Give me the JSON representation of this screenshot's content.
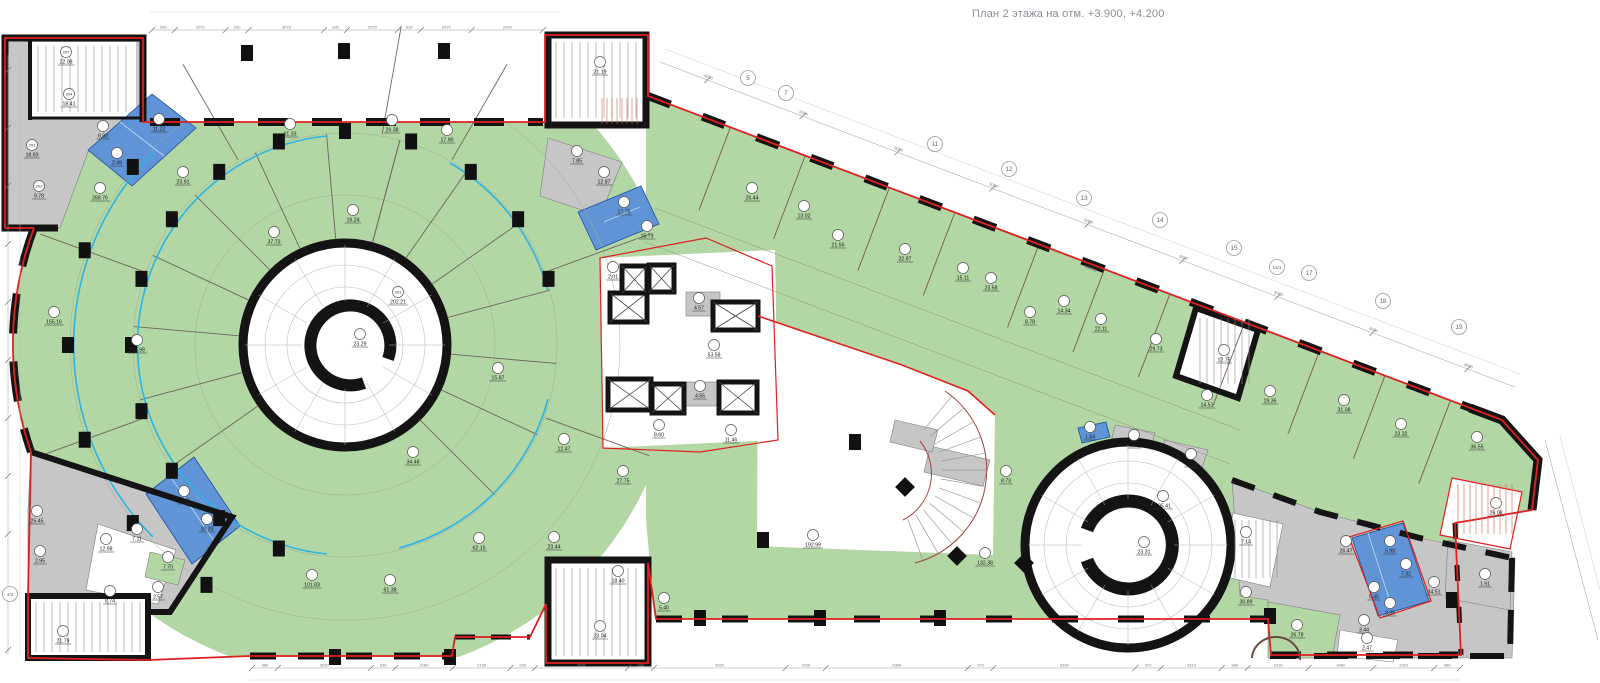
{
  "title": "План 2 этажа на отм. +3.900, +4.200",
  "colors": {
    "floor_green": "#b2d6a4",
    "wet_room_blue": "#6194d6",
    "service_gray": "#c6c6c6",
    "boundary_red": "#e02020",
    "partition_cyan": "#2ab5e8",
    "wall_black": "#141414"
  },
  "plan": {
    "rooms": [
      {
        "no": "207",
        "area": "22.08",
        "x": 66,
        "y": 62
      },
      {
        "no": "204",
        "area": "18.41",
        "x": 69,
        "y": 104
      },
      {
        "no": "203",
        "area": "18.83",
        "x": 32,
        "y": 155
      },
      {
        "no": "202",
        "area": "9.78",
        "x": 39,
        "y": 196
      },
      {
        "no": "",
        "area": "8.93",
        "x": 103,
        "y": 136
      },
      {
        "no": "",
        "area": "11.22",
        "x": 159,
        "y": 129
      },
      {
        "no": "",
        "area": "2.49",
        "x": 117,
        "y": 163
      },
      {
        "no": "",
        "area": "23.91",
        "x": 183,
        "y": 182
      },
      {
        "no": "",
        "area": "268.76",
        "x": 100,
        "y": 198
      },
      {
        "no": "",
        "area": "61.33",
        "x": 290,
        "y": 134
      },
      {
        "no": "",
        "area": "29.38",
        "x": 392,
        "y": 130
      },
      {
        "no": "",
        "area": "17.90",
        "x": 447,
        "y": 140
      },
      {
        "no": "",
        "area": "16.24",
        "x": 353,
        "y": 220
      },
      {
        "no": "",
        "area": "37.73",
        "x": 274,
        "y": 242
      },
      {
        "no": "",
        "area": "155.16",
        "x": 54,
        "y": 322
      },
      {
        "no": "",
        "area": "105.98",
        "x": 137,
        "y": 350
      },
      {
        "no": "201",
        "area": "202.21",
        "x": 398,
        "y": 302
      },
      {
        "no": "",
        "area": "23.29",
        "x": 360,
        "y": 344
      },
      {
        "no": "",
        "area": "15.87",
        "x": 498,
        "y": 378
      },
      {
        "no": "",
        "area": "12.47",
        "x": 564,
        "y": 449
      },
      {
        "no": "",
        "area": "27.75",
        "x": 623,
        "y": 481
      },
      {
        "no": "",
        "area": "34.48",
        "x": 413,
        "y": 462
      },
      {
        "no": "",
        "area": "101.83",
        "x": 312,
        "y": 585
      },
      {
        "no": "",
        "area": "61.38",
        "x": 390,
        "y": 590
      },
      {
        "no": "",
        "area": "62.15",
        "x": 479,
        "y": 548
      },
      {
        "no": "",
        "area": "23.44",
        "x": 554,
        "y": 547
      },
      {
        "no": "",
        "area": "21.19",
        "x": 600,
        "y": 72
      },
      {
        "no": "",
        "area": "7.85",
        "x": 577,
        "y": 161
      },
      {
        "no": "",
        "area": "12.87",
        "x": 604,
        "y": 182
      },
      {
        "no": "",
        "area": "17.75",
        "x": 624,
        "y": 212
      },
      {
        "no": "",
        "area": "15.79",
        "x": 647,
        "y": 236
      },
      {
        "no": "",
        "area": "2.01",
        "x": 613,
        "y": 277
      },
      {
        "no": "",
        "area": "4.57",
        "x": 699,
        "y": 308
      },
      {
        "no": "",
        "area": "53.58",
        "x": 714,
        "y": 355
      },
      {
        "no": "",
        "area": "4.55",
        "x": 700,
        "y": 396
      },
      {
        "no": "",
        "area": "8.60",
        "x": 659,
        "y": 435
      },
      {
        "no": "",
        "area": "11.46",
        "x": 731,
        "y": 440
      },
      {
        "no": "",
        "area": "26.44",
        "x": 752,
        "y": 198
      },
      {
        "no": "",
        "area": "13.02",
        "x": 804,
        "y": 216
      },
      {
        "no": "",
        "area": "21.56",
        "x": 838,
        "y": 245
      },
      {
        "no": "",
        "area": "32.87",
        "x": 905,
        "y": 259
      },
      {
        "no": "",
        "area": "15.11",
        "x": 963,
        "y": 278
      },
      {
        "no": "",
        "area": "23.58",
        "x": 991,
        "y": 288
      },
      {
        "no": "",
        "area": "8.78",
        "x": 1030,
        "y": 322
      },
      {
        "no": "",
        "area": "14.34",
        "x": 1064,
        "y": 311
      },
      {
        "no": "",
        "area": "22.11",
        "x": 1101,
        "y": 329
      },
      {
        "no": "",
        "area": "29.73",
        "x": 1156,
        "y": 349
      },
      {
        "no": "",
        "area": "12.75",
        "x": 1224,
        "y": 360
      },
      {
        "no": "",
        "area": "14.51",
        "x": 1207,
        "y": 405
      },
      {
        "no": "",
        "area": "19.36",
        "x": 1270,
        "y": 401
      },
      {
        "no": "",
        "area": "31.08",
        "x": 1344,
        "y": 410
      },
      {
        "no": "",
        "area": "23.32",
        "x": 1401,
        "y": 434
      },
      {
        "no": "",
        "area": "36.55",
        "x": 1477,
        "y": 447
      },
      {
        "no": "",
        "area": "26.08",
        "x": 1496,
        "y": 513
      },
      {
        "no": "",
        "area": "8.73",
        "x": 1006,
        "y": 481
      },
      {
        "no": "",
        "area": "132.38",
        "x": 985,
        "y": 563
      },
      {
        "no": "",
        "area": "192.99",
        "x": 813,
        "y": 545
      },
      {
        "no": "",
        "area": "18.40",
        "x": 618,
        "y": 581
      },
      {
        "no": "",
        "area": "5.40",
        "x": 664,
        "y": 608
      },
      {
        "no": "",
        "area": "23.04",
        "x": 600,
        "y": 636
      },
      {
        "no": "",
        "area": "205.41",
        "x": 1163,
        "y": 506
      },
      {
        "no": "",
        "area": "23.31",
        "x": 1144,
        "y": 552
      },
      {
        "no": "",
        "area": "1.84",
        "x": 1090,
        "y": 437
      },
      {
        "no": "",
        "area": "2.89",
        "x": 1134,
        "y": 445
      },
      {
        "no": "",
        "area": "2.05",
        "x": 1191,
        "y": 464
      },
      {
        "no": "",
        "area": "7.14",
        "x": 1246,
        "y": 542
      },
      {
        "no": "",
        "area": "30.89",
        "x": 1246,
        "y": 602
      },
      {
        "no": "",
        "area": "26.47",
        "x": 1346,
        "y": 551
      },
      {
        "no": "",
        "area": "5.99",
        "x": 1390,
        "y": 551
      },
      {
        "no": "",
        "area": "7.32",
        "x": 1406,
        "y": 574
      },
      {
        "no": "",
        "area": "5.45",
        "x": 1374,
        "y": 597
      },
      {
        "no": "",
        "area": "3.35",
        "x": 1390,
        "y": 613
      },
      {
        "no": "",
        "area": "34.51",
        "x": 1434,
        "y": 592
      },
      {
        "no": "",
        "area": "1.91",
        "x": 1485,
        "y": 584
      },
      {
        "no": "",
        "area": "26.78",
        "x": 1297,
        "y": 635
      },
      {
        "no": "",
        "area": "3.44",
        "x": 1364,
        "y": 630
      },
      {
        "no": "",
        "area": "2.47",
        "x": 1367,
        "y": 648
      },
      {
        "no": "",
        "area": "25.45",
        "x": 37,
        "y": 521
      },
      {
        "no": "",
        "area": "2.95",
        "x": 40,
        "y": 561
      },
      {
        "no": "",
        "area": "9.97",
        "x": 184,
        "y": 501
      },
      {
        "no": "",
        "area": "10.33",
        "x": 207,
        "y": 529
      },
      {
        "no": "",
        "area": "7.11",
        "x": 137,
        "y": 539
      },
      {
        "no": "",
        "area": "12.98",
        "x": 106,
        "y": 549
      },
      {
        "no": "",
        "area": "7.70",
        "x": 168,
        "y": 567
      },
      {
        "no": "",
        "area": "8.74",
        "x": 110,
        "y": 601
      },
      {
        "no": "",
        "area": "2.57",
        "x": 158,
        "y": 597
      },
      {
        "no": "",
        "area": "21.79",
        "x": 63,
        "y": 641
      }
    ],
    "grid_bubbles": [
      {
        "label": "5",
        "x": 748,
        "y": 78
      },
      {
        "label": "7",
        "x": 786,
        "y": 93
      },
      {
        "label": "11",
        "x": 935,
        "y": 144
      },
      {
        "label": "12",
        "x": 1009,
        "y": 169
      },
      {
        "label": "13",
        "x": 1084,
        "y": 198
      },
      {
        "label": "14",
        "x": 1160,
        "y": 220
      },
      {
        "label": "15",
        "x": 1234,
        "y": 248
      },
      {
        "label": "15/1",
        "x": 1277,
        "y": 267
      },
      {
        "label": "17",
        "x": 1309,
        "y": 273
      },
      {
        "label": "18",
        "x": 1383,
        "y": 301
      },
      {
        "label": "19",
        "x": 1459,
        "y": 327
      },
      {
        "label": "4/3",
        "x": 10,
        "y": 594
      }
    ],
    "dimensions": {
      "top": [
        "930",
        "2070",
        "930",
        "3070",
        "930",
        "2070",
        "930",
        "2070",
        "2900"
      ],
      "bottom": [
        "980",
        "3530",
        "930",
        "2180",
        "2190",
        "930",
        "3530",
        "980",
        "5000",
        "1530",
        "5390",
        "970",
        "5390",
        "970",
        "2310",
        "980",
        "2310",
        "2460",
        "2310",
        "980"
      ],
      "grid_spacing": "6000",
      "grid_total": "66000"
    }
  }
}
